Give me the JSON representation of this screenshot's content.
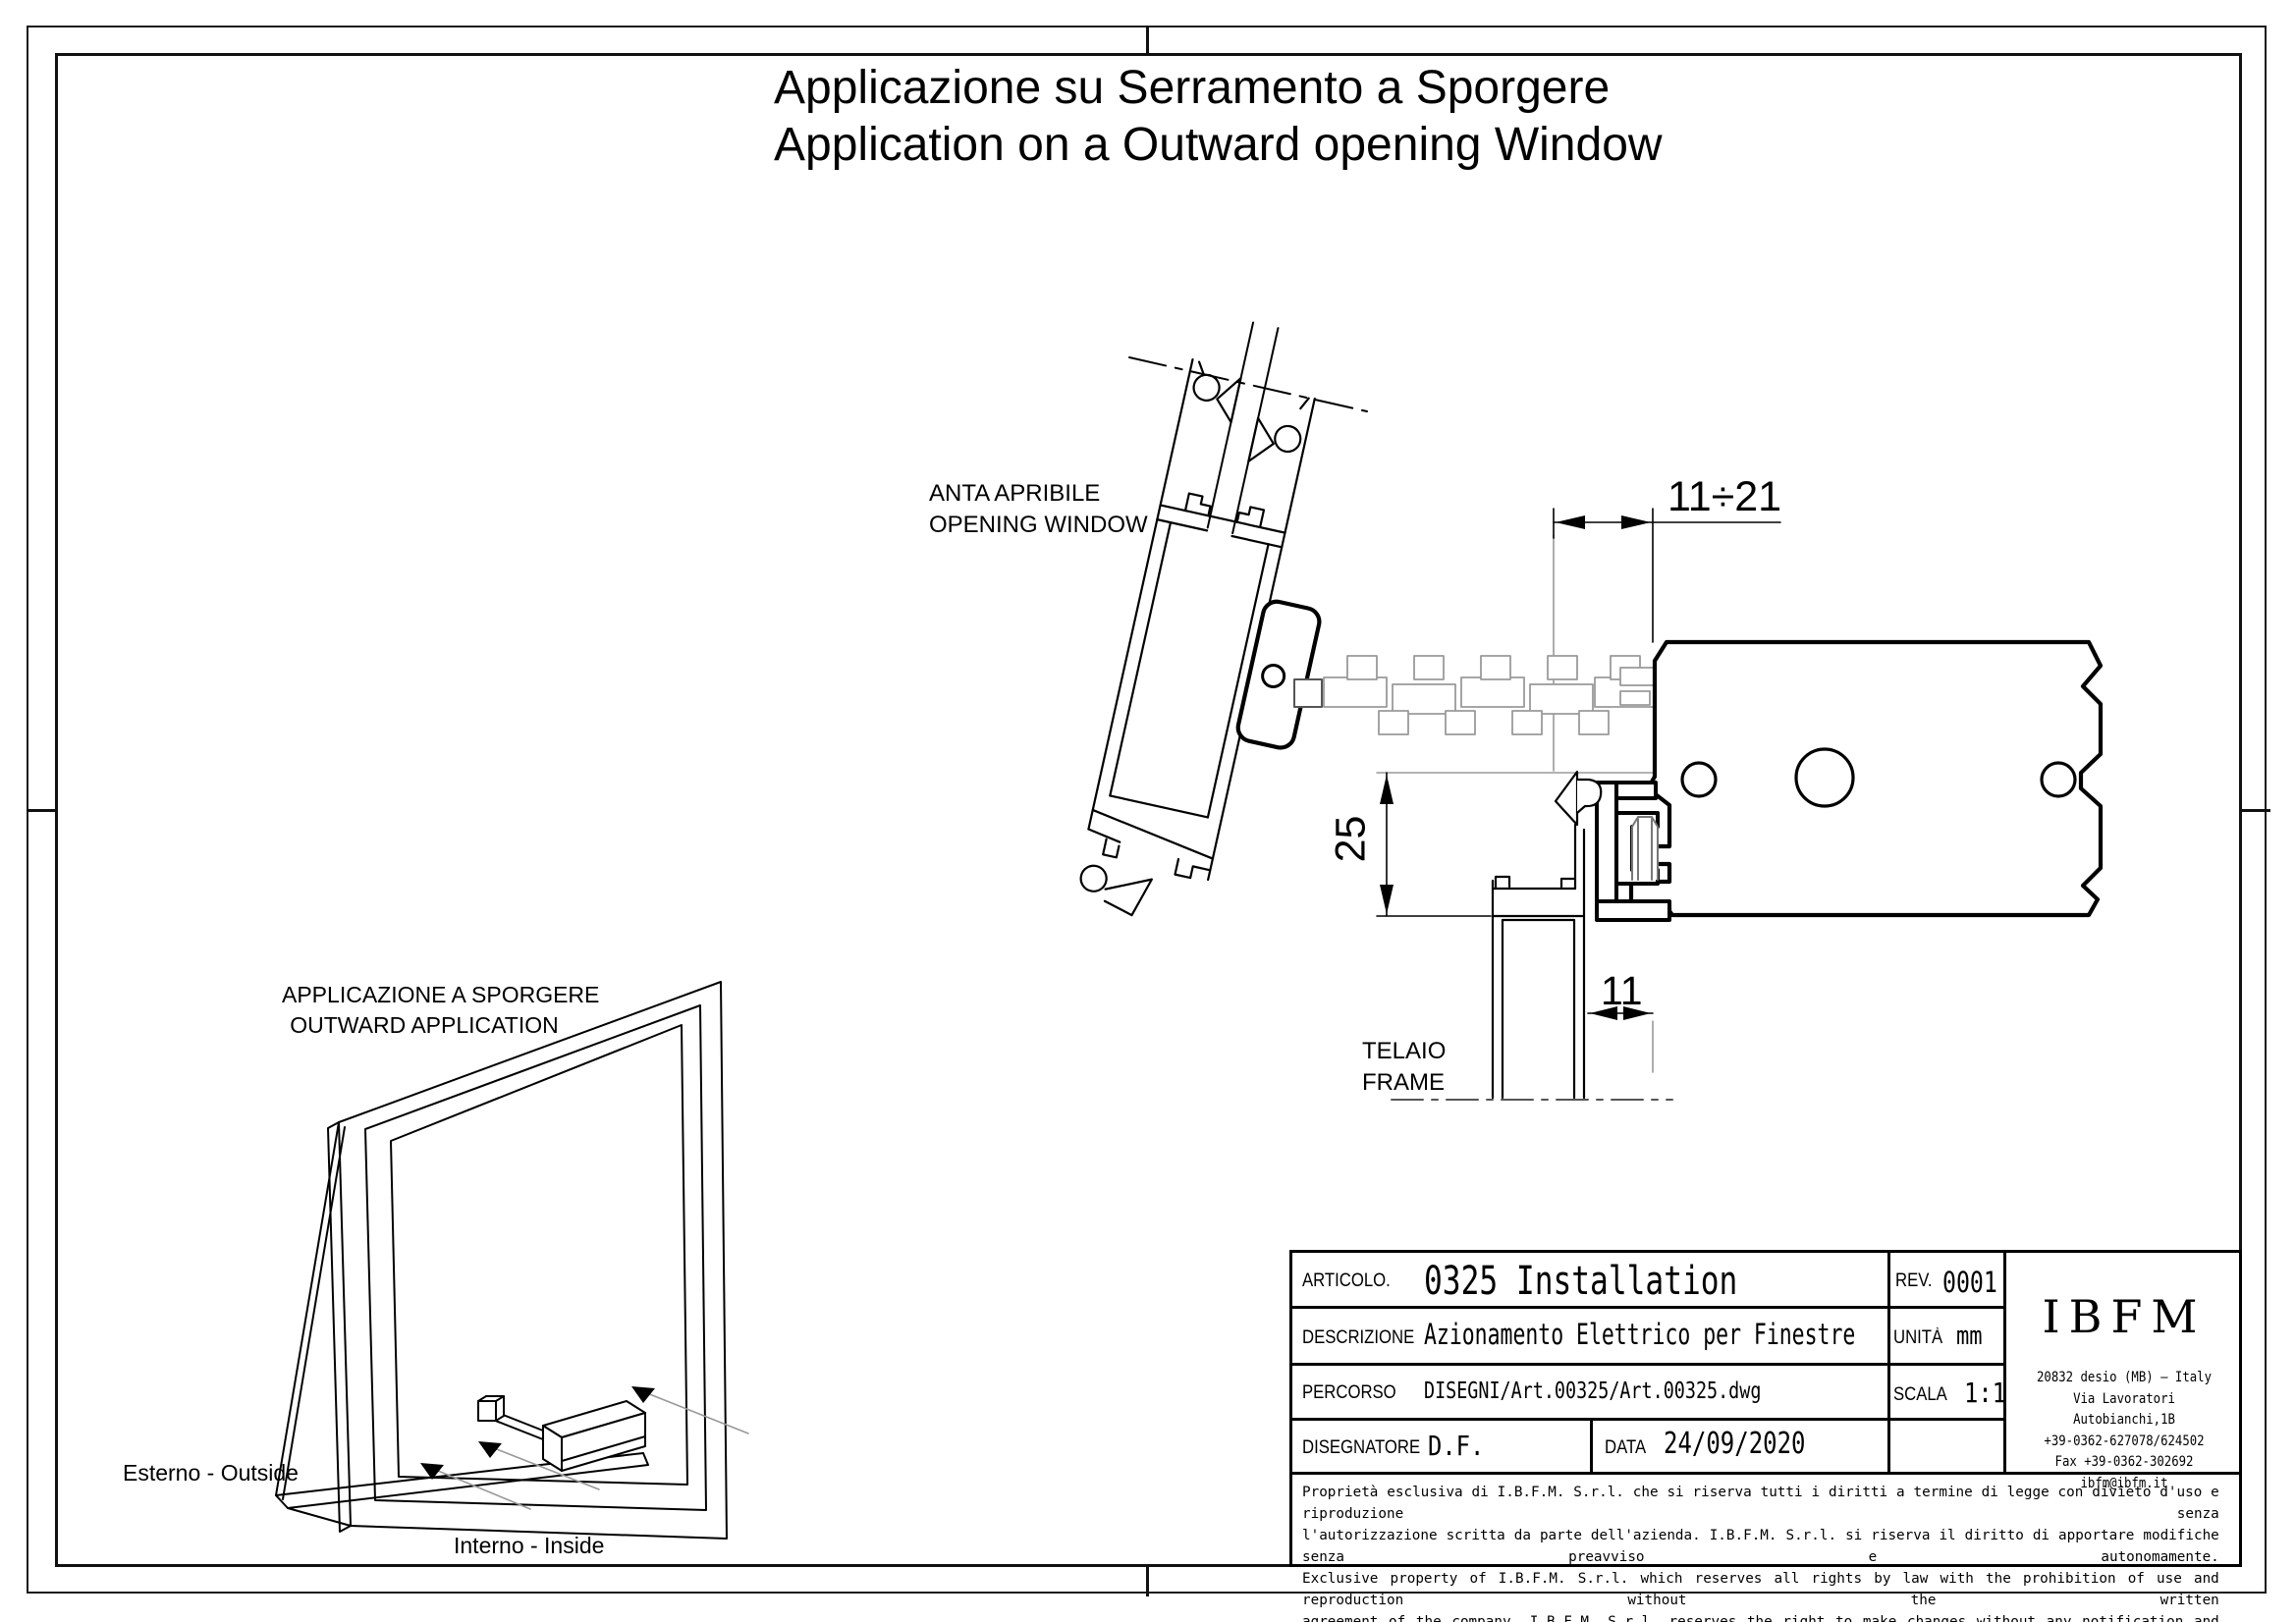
{
  "page_title": {
    "line1": "Applicazione su Serramento a Sporgere",
    "line2": "Application on a Outward opening Window"
  },
  "left_view": {
    "caption_line1": "APPLICAZIONE A SPORGERE",
    "caption_line2": "OUTWARD APPLICATION",
    "exterior_label": "Esterno - Outside",
    "interior_label": "Interno - Inside"
  },
  "right_view": {
    "sash_label_line1": "ANTA APRIBILE",
    "sash_label_line2": "OPENING WINDOW",
    "frame_label_line1": "TELAIO",
    "frame_label_line2": "FRAME",
    "dim_gap": "11÷21",
    "dim_height": "25",
    "dim_offset": "11"
  },
  "title_block": {
    "articolo_label": "ARTICOLO.",
    "articolo_value": "0325 Installation",
    "rev_label": "REV.",
    "rev_value": "0001",
    "descrizione_label": "DESCRIZIONE",
    "descrizione_value": "Azionamento Elettrico per Finestre",
    "unita_label": "UNITÀ",
    "unita_value": "mm",
    "percorso_label": "PERCORSO",
    "percorso_value": "DISEGNI/Art.00325/Art.00325.dwg",
    "scala_label": "SCALA",
    "scala_value": "1:1",
    "disegnatore_label": "DISEGNATORE",
    "disegnatore_value": "D.F.",
    "data_label": "DATA",
    "data_value": "24/09/2020",
    "company": {
      "logo_text": "IBFM",
      "address_line1": "20832 desio (MB) – Italy",
      "address_line2": "Via Lavoratori Autobianchi,1B",
      "address_line3": "+39-0362-627078/624502",
      "address_line4": "Fax +39-0362-302692",
      "address_line5": "ibfm@ibfm.it"
    },
    "legal_line1": "Proprietà esclusiva di I.B.F.M. S.r.l. che si riserva tutti i diritti a termine di legge con divieto d'uso e riproduzione senza",
    "legal_line2": "l'autorizzazione scritta da parte dell'azienda. I.B.F.M. S.r.l. si riserva il diritto di apportare modifiche senza preavviso e autonomamente.",
    "legal_line3": "Exclusive property of I.B.F.M. S.r.l. which reserves all rights by law with the prohibition of use and reproduction without the written",
    "legal_line4": "agreement of the company. I.B.F.M. S.r.l. reserves the right to make changes without any notification and independently."
  }
}
